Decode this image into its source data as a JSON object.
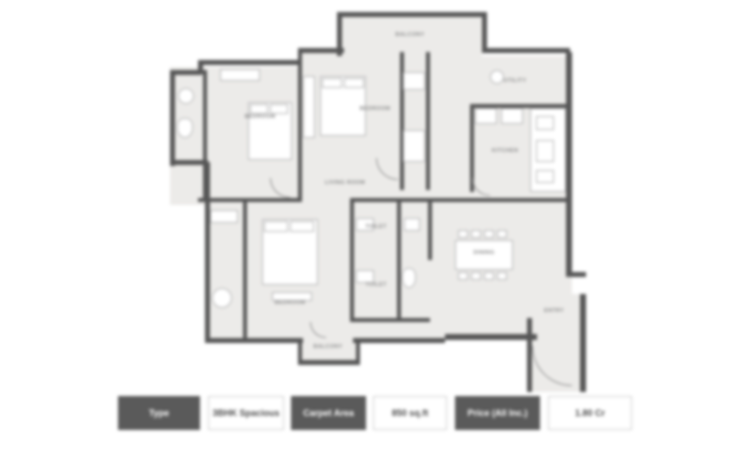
{
  "floor_plan": {
    "labels": [
      {
        "text": "BALCONY"
      },
      {
        "text": "UTILITY"
      },
      {
        "text": "BEDROOM"
      },
      {
        "text": "BEDROOM"
      },
      {
        "text": "KITCHEN"
      },
      {
        "text": "LIVING ROOM"
      },
      {
        "text": "DINING"
      },
      {
        "text": "TOILET"
      },
      {
        "text": "TOILET"
      },
      {
        "text": "BEDROOM"
      },
      {
        "text": "BALCONY"
      },
      {
        "text": "ENTRY"
      }
    ]
  },
  "info_bar": {
    "cells": [
      {
        "text": "Type",
        "variant": "dark"
      },
      {
        "text": "3BHK Spacious",
        "variant": "light"
      },
      {
        "text": "Carpet Area",
        "variant": "dark"
      },
      {
        "text": "850 sq.ft",
        "variant": "light"
      },
      {
        "text": "Price (All Inc.)",
        "variant": "dark"
      },
      {
        "text": "1.80 Cr",
        "variant": "light"
      }
    ]
  },
  "colors": {
    "wall": "#565656",
    "floor": "#ecebe9",
    "dark_cell": "#5a5a5a",
    "light_cell_border": "#cfcfcf"
  }
}
